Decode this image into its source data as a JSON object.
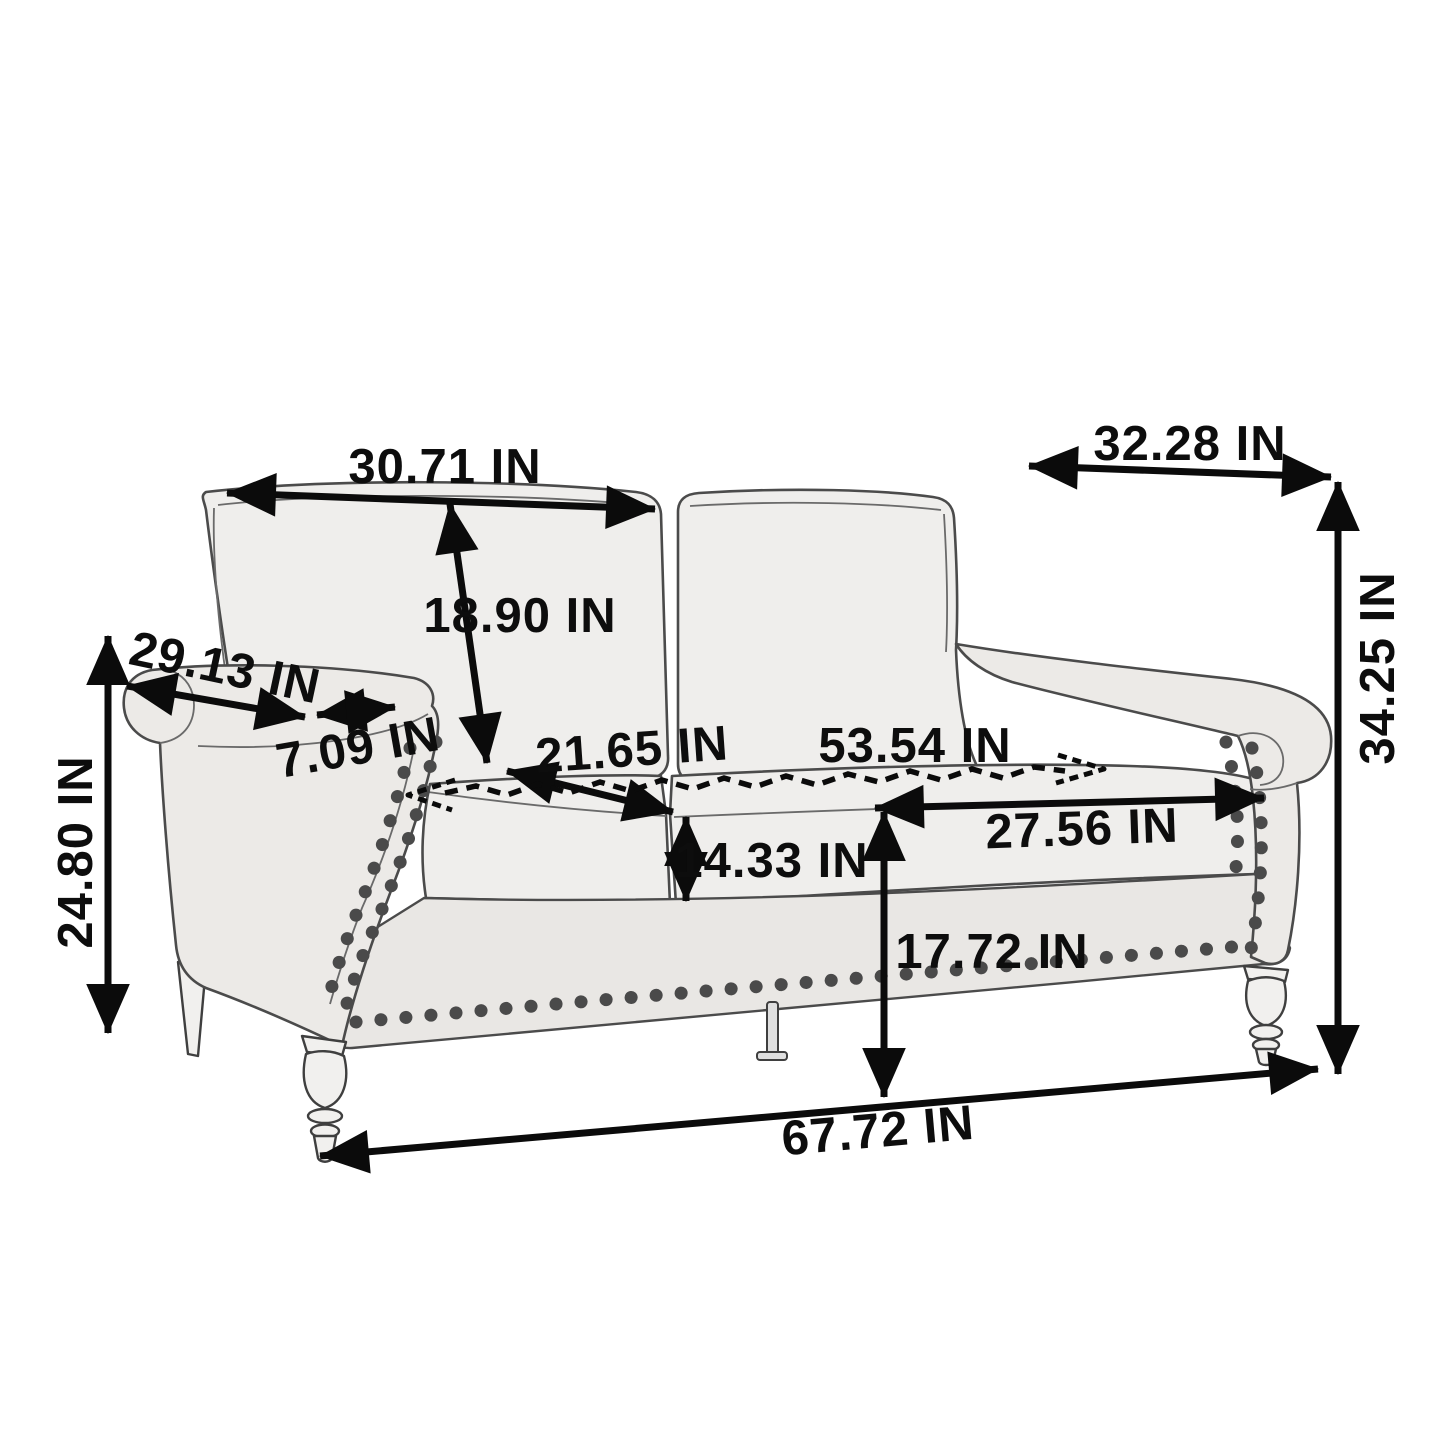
{
  "diagram": {
    "unit": "IN",
    "dimensions": {
      "back_cushion_width": "30.71 IN",
      "back_cushion_height": "18.90 IN",
      "arm_length": "29.13 IN",
      "arm_top_width": "7.09 IN",
      "seat_depth": "21.65 IN",
      "seat_width_total": "53.54 IN",
      "seat_cushion_width": "27.56 IN",
      "seat_cushion_thickness": "14.33 IN",
      "seat_height": "17.72 IN",
      "overall_depth": "32.28 IN",
      "overall_height": "34.25 IN",
      "arm_height": "24.80 IN",
      "overall_width": "67.72 IN"
    }
  }
}
